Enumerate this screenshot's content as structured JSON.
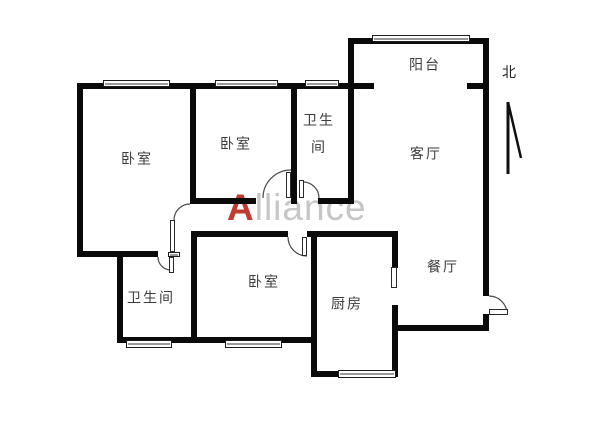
{
  "watermark": {
    "prefix": "A",
    "rest": "lliance",
    "prefix_color": "#c23b32",
    "rest_color": "#c6c6c6"
  },
  "compass": {
    "label": "北",
    "label_x": 509,
    "label_y": 72,
    "arrow_lines": [
      [
        508,
        102,
        508,
        174
      ],
      [
        508,
        102,
        521,
        158
      ]
    ]
  },
  "colors": {
    "wall": "#0a0a0a",
    "background": "#ffffff",
    "label_text": "#3c3c3c"
  },
  "floorplan": {
    "labels": [
      {
        "id": "bedroom-1",
        "text": "卧室",
        "cx": 137,
        "cy": 160
      },
      {
        "id": "bedroom-2",
        "text": "卧室",
        "cx": 236,
        "cy": 145
      },
      {
        "id": "bathroom-1",
        "text": "卫生\n间",
        "cx": 319,
        "cy": 135
      },
      {
        "id": "balcony",
        "text": "阳台",
        "cx": 425,
        "cy": 66
      },
      {
        "id": "living-room",
        "text": "客厅",
        "cx": 426,
        "cy": 155
      },
      {
        "id": "dining-room",
        "text": "餐厅",
        "cx": 443,
        "cy": 268
      },
      {
        "id": "kitchen",
        "text": "厨房",
        "cx": 347,
        "cy": 305
      },
      {
        "id": "bedroom-3",
        "text": "卧室",
        "cx": 264,
        "cy": 283
      },
      {
        "id": "bathroom-2",
        "text": "卫生间",
        "cx": 151,
        "cy": 299
      }
    ],
    "walls": [
      {
        "id": "top-wall",
        "x": 77,
        "y": 83,
        "w": 277,
        "h": 6
      },
      {
        "id": "left-wall",
        "x": 77,
        "y": 83,
        "w": 6,
        "h": 174
      },
      {
        "id": "balcony-top-wall",
        "x": 348,
        "y": 38,
        "w": 141,
        "h": 6
      },
      {
        "id": "balcony-left-wall",
        "x": 348,
        "y": 38,
        "w": 6,
        "h": 165
      },
      {
        "id": "right-wall-upper",
        "x": 483,
        "y": 38,
        "w": 6,
        "h": 258
      },
      {
        "id": "right-wall-lower",
        "x": 483,
        "y": 314,
        "w": 6,
        "h": 17
      },
      {
        "id": "balcony-sill-left",
        "x": 348,
        "y": 83,
        "w": 26,
        "h": 6
      },
      {
        "id": "balcony-sill-right",
        "x": 467,
        "y": 83,
        "w": 22,
        "h": 6
      },
      {
        "id": "divider-bed1-bed2",
        "x": 190,
        "y": 83,
        "w": 6,
        "h": 121
      },
      {
        "id": "divider-bed2-bath1",
        "x": 291,
        "y": 83,
        "w": 6,
        "h": 121
      },
      {
        "id": "hall-upper-wall-left",
        "x": 190,
        "y": 198,
        "w": 66,
        "h": 6
      },
      {
        "id": "hall-upper-wall-right",
        "x": 318,
        "y": 198,
        "w": 36,
        "h": 6
      },
      {
        "id": "hall-lower-wall-left",
        "x": 191,
        "y": 231,
        "w": 97,
        "h": 6
      },
      {
        "id": "hall-lower-wall-right",
        "x": 307,
        "y": 231,
        "w": 91,
        "h": 6
      },
      {
        "id": "divider-bath2-bed3",
        "x": 191,
        "y": 231,
        "w": 6,
        "h": 112
      },
      {
        "id": "bed1-bottom-wall",
        "x": 77,
        "y": 251,
        "w": 81,
        "h": 6
      },
      {
        "id": "bath2-left-wall",
        "x": 117,
        "y": 251,
        "w": 6,
        "h": 92
      },
      {
        "id": "bottom-wall",
        "x": 117,
        "y": 337,
        "w": 200,
        "h": 6
      },
      {
        "id": "kitchen-left-wall",
        "x": 311,
        "y": 231,
        "w": 6,
        "h": 146
      },
      {
        "id": "kitchen-bottom-wall",
        "x": 311,
        "y": 371,
        "w": 87,
        "h": 6
      },
      {
        "id": "kitchen-right-wall-upper",
        "x": 392,
        "y": 231,
        "w": 6,
        "h": 37
      },
      {
        "id": "kitchen-right-wall-lower",
        "x": 392,
        "y": 305,
        "w": 6,
        "h": 72
      },
      {
        "id": "dining-bottom-wall",
        "x": 392,
        "y": 325,
        "w": 97,
        "h": 6
      }
    ],
    "windows": [
      {
        "id": "window-bedroom1-top",
        "x": 103,
        "y": 80,
        "w": 67,
        "h": 7
      },
      {
        "id": "window-bedroom2-top",
        "x": 215,
        "y": 80,
        "w": 63,
        "h": 7
      },
      {
        "id": "window-bathroom1-top",
        "x": 305,
        "y": 80,
        "w": 34,
        "h": 7
      },
      {
        "id": "window-balcony-top",
        "x": 372,
        "y": 35,
        "w": 98,
        "h": 7
      },
      {
        "id": "window-bathroom2-bottom",
        "x": 126,
        "y": 340,
        "w": 46,
        "h": 8
      },
      {
        "id": "window-bedroom3-bottom",
        "x": 225,
        "y": 340,
        "w": 57,
        "h": 8
      },
      {
        "id": "window-kitchen-bottom",
        "x": 338,
        "y": 370,
        "w": 58,
        "h": 8
      },
      {
        "id": "threshold-bathroom2",
        "x": 168,
        "y": 252,
        "w": 12,
        "h": 5
      }
    ],
    "door_leaves": [
      {
        "id": "door-leaf-bedroom1",
        "x": 170,
        "y": 220,
        "w": 5,
        "h": 32,
        "vslot": true
      },
      {
        "id": "door-leaf-bathroom2",
        "x": 169,
        "y": 257,
        "w": 5,
        "h": 16,
        "vslot": true
      },
      {
        "id": "door-leaf-bedroom2",
        "x": 286,
        "y": 172,
        "w": 5,
        "h": 26,
        "vslot": true
      },
      {
        "id": "door-leaf-bathroom1",
        "x": 299,
        "y": 180,
        "w": 5,
        "h": 18,
        "vslot": true
      },
      {
        "id": "door-leaf-bedroom3",
        "x": 302,
        "y": 237,
        "w": 5,
        "h": 19,
        "vslot": true
      },
      {
        "id": "door-leaf-kitchen",
        "x": 391,
        "y": 267,
        "w": 6,
        "h": 21,
        "vslot": true
      },
      {
        "id": "door-leaf-entry",
        "x": 489,
        "y": 309,
        "w": 19,
        "h": 6,
        "vslot": false
      }
    ],
    "door_arcs": [
      {
        "id": "door-arc-bedroom1",
        "d": "M190,204 A16,16 0 0 0 174,220"
      },
      {
        "id": "door-arc-bathroom2",
        "d": "M158,257 A13,13 0 0 0 171,270"
      },
      {
        "id": "door-arc-bedroom2",
        "d": "M263,198 A28,28 0 0 1 291,170"
      },
      {
        "id": "door-arc-bathroom1",
        "d": "M303,182 A16,16 0 0 1 319,198"
      },
      {
        "id": "door-arc-bedroom3",
        "d": "M288,237 A19,19 0 0 0 307,256"
      },
      {
        "id": "door-arc-entry",
        "d": "M489,296 A18,18 0 0 1 507,314"
      }
    ]
  }
}
